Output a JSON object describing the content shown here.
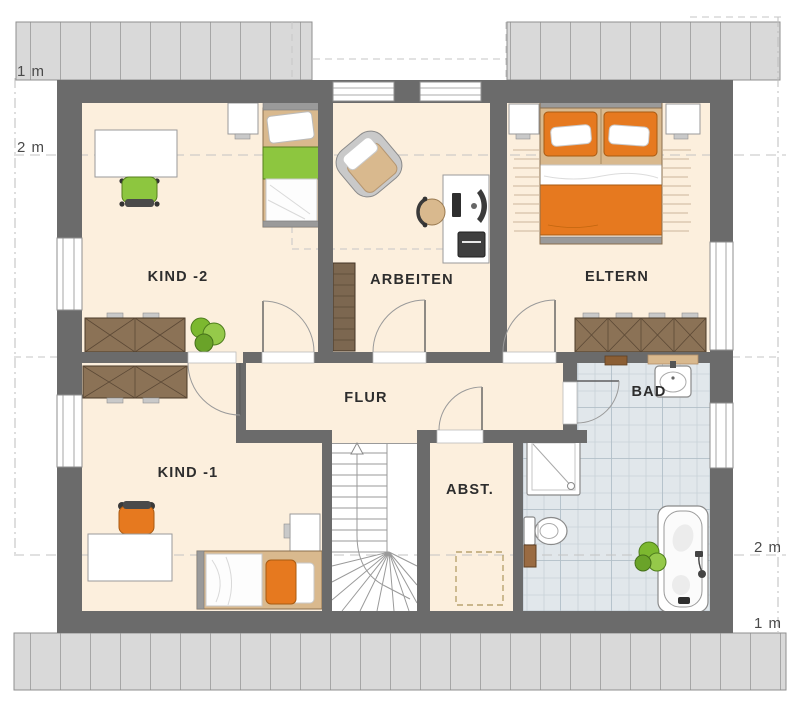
{
  "plan": {
    "type": "floor-plan",
    "rooms": {
      "kind2": "KIND -2",
      "arbeiten": "ARBEITEN",
      "eltern": "ELTERN",
      "flur": "FLUR",
      "kind1": "KIND -1",
      "abst": "ABST.",
      "bad": "BAD"
    },
    "measurements": {
      "left_1m": "1 m",
      "left_2m": "2 m",
      "right_2m": "2 m",
      "right_1m": "1 m"
    },
    "colors": {
      "wall": "#6b6b6b",
      "floor": "#fcefdd",
      "bath_tile": "#e1e7eb",
      "roof_overhang": "#d9d9d9",
      "wood_dark": "#8b7256",
      "wood_light": "#d9b98e",
      "accent_orange": "#e6791f",
      "accent_green": "#8dc63f"
    }
  }
}
